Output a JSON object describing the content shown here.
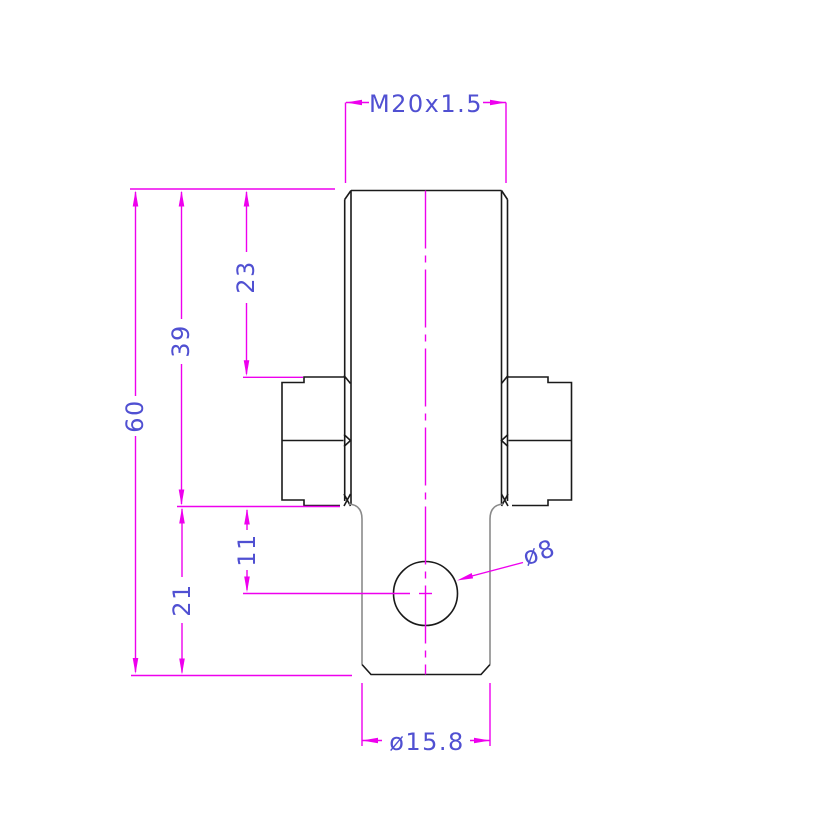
{
  "colors": {
    "dimension_line": "#ee00ee",
    "dimension_text": "#5050d2",
    "outline": "#1a1a1a",
    "secondary_line": "#8a8a8a",
    "background": "#ffffff"
  },
  "dimensions": {
    "thread": "M20x1.5",
    "thread_length": "23",
    "body_length": "39",
    "overall_length": "60",
    "hole_offset": "11",
    "tail_length": "21",
    "hole_diameter": "ø8",
    "tail_diameter": "ø15.8"
  }
}
